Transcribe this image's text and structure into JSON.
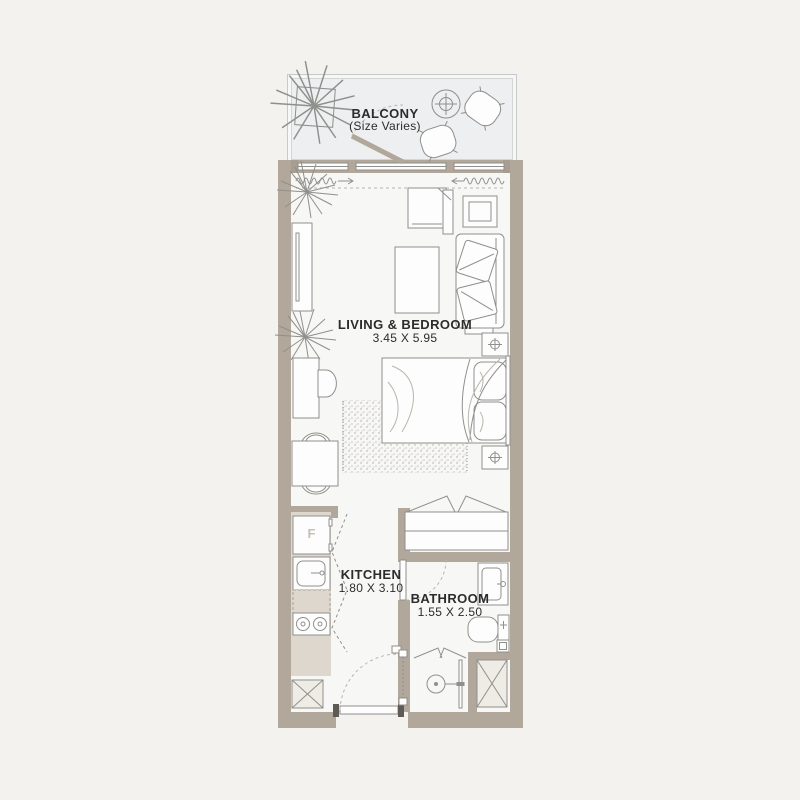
{
  "rooms": {
    "balcony": {
      "label": "BALCONY",
      "sublabel": "(Size Varies)"
    },
    "living_bedroom": {
      "label": "LIVING & BEDROOM",
      "dimensions": "3.45 X 5.95"
    },
    "kitchen": {
      "label": "KITCHEN",
      "dimensions": "1.80 X 3.10"
    },
    "bathroom": {
      "label": "BATHROOM",
      "dimensions": "1.55 X 2.50"
    }
  },
  "appliances": {
    "fridge_label": "F"
  },
  "colors": {
    "page_background": "#f3f2ef",
    "wall": "#b1a79a",
    "unit_floor": "#f7f7f5",
    "balcony_floor": "#edeff1",
    "counter": "#ded7cd",
    "shaft_fill": "#efece6",
    "furniture_line": "#8f8f8c",
    "text": "#2c2c2c"
  },
  "furniture": {
    "balcony": [
      "plant",
      "round-table",
      "lounge-chair",
      "lounge-chair"
    ],
    "living_bedroom": [
      "plant",
      "tv-unit",
      "corner-sofa",
      "side-table",
      "armchair",
      "coffee-table",
      "plant",
      "desk",
      "desk-chair",
      "dining-table",
      "dining-chair",
      "dining-chair",
      "rug",
      "double-bed",
      "nightstand",
      "nightstand",
      "wardrobe"
    ],
    "kitchen": [
      "fridge",
      "sink",
      "cooktop",
      "counter"
    ],
    "bathroom": [
      "vanity-sink",
      "toilet",
      "washer",
      "shower"
    ],
    "circulation": [
      "balcony-door",
      "entry-door",
      "bathroom-door",
      "curtains",
      "windows",
      "shaft",
      "shaft"
    ]
  }
}
